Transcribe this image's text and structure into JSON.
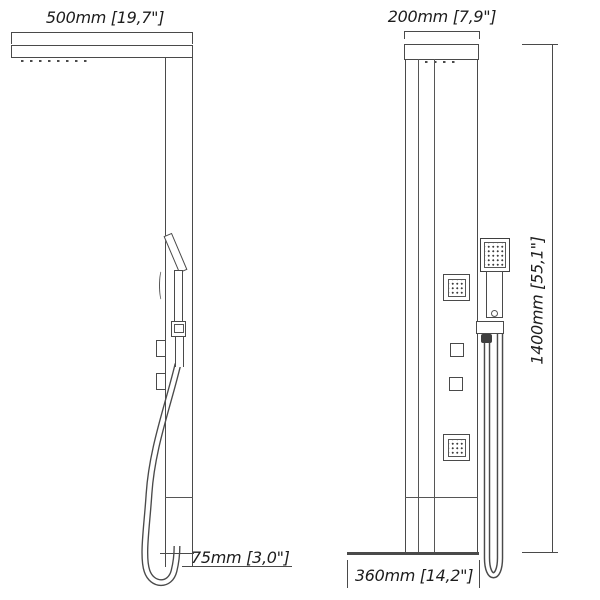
{
  "drawing_type": "shower panel technical dimension drawing, two orthographic views",
  "labels": {
    "arm_depth": "500mm [19,7\"]",
    "panel_width": "200mm [7,9\"]",
    "panel_height": "1400mm [55,1\"]",
    "bottom_section": "75mm [3,0\"]",
    "base_width": "360mm [14,2\"]"
  },
  "colors": {
    "line": "#4a4a4a",
    "text": "#1d1d1d",
    "background": "#ffffff"
  },
  "views": {
    "side_view_parts": "overhead shower arm, panel column, tiltable hand shower in bracket, two control knobs, hanging hose loop",
    "front_view_parts": "top cap, panel face, two square body jets, two square control knobs, square hand shower on bracket, double hose run, base spout section"
  }
}
